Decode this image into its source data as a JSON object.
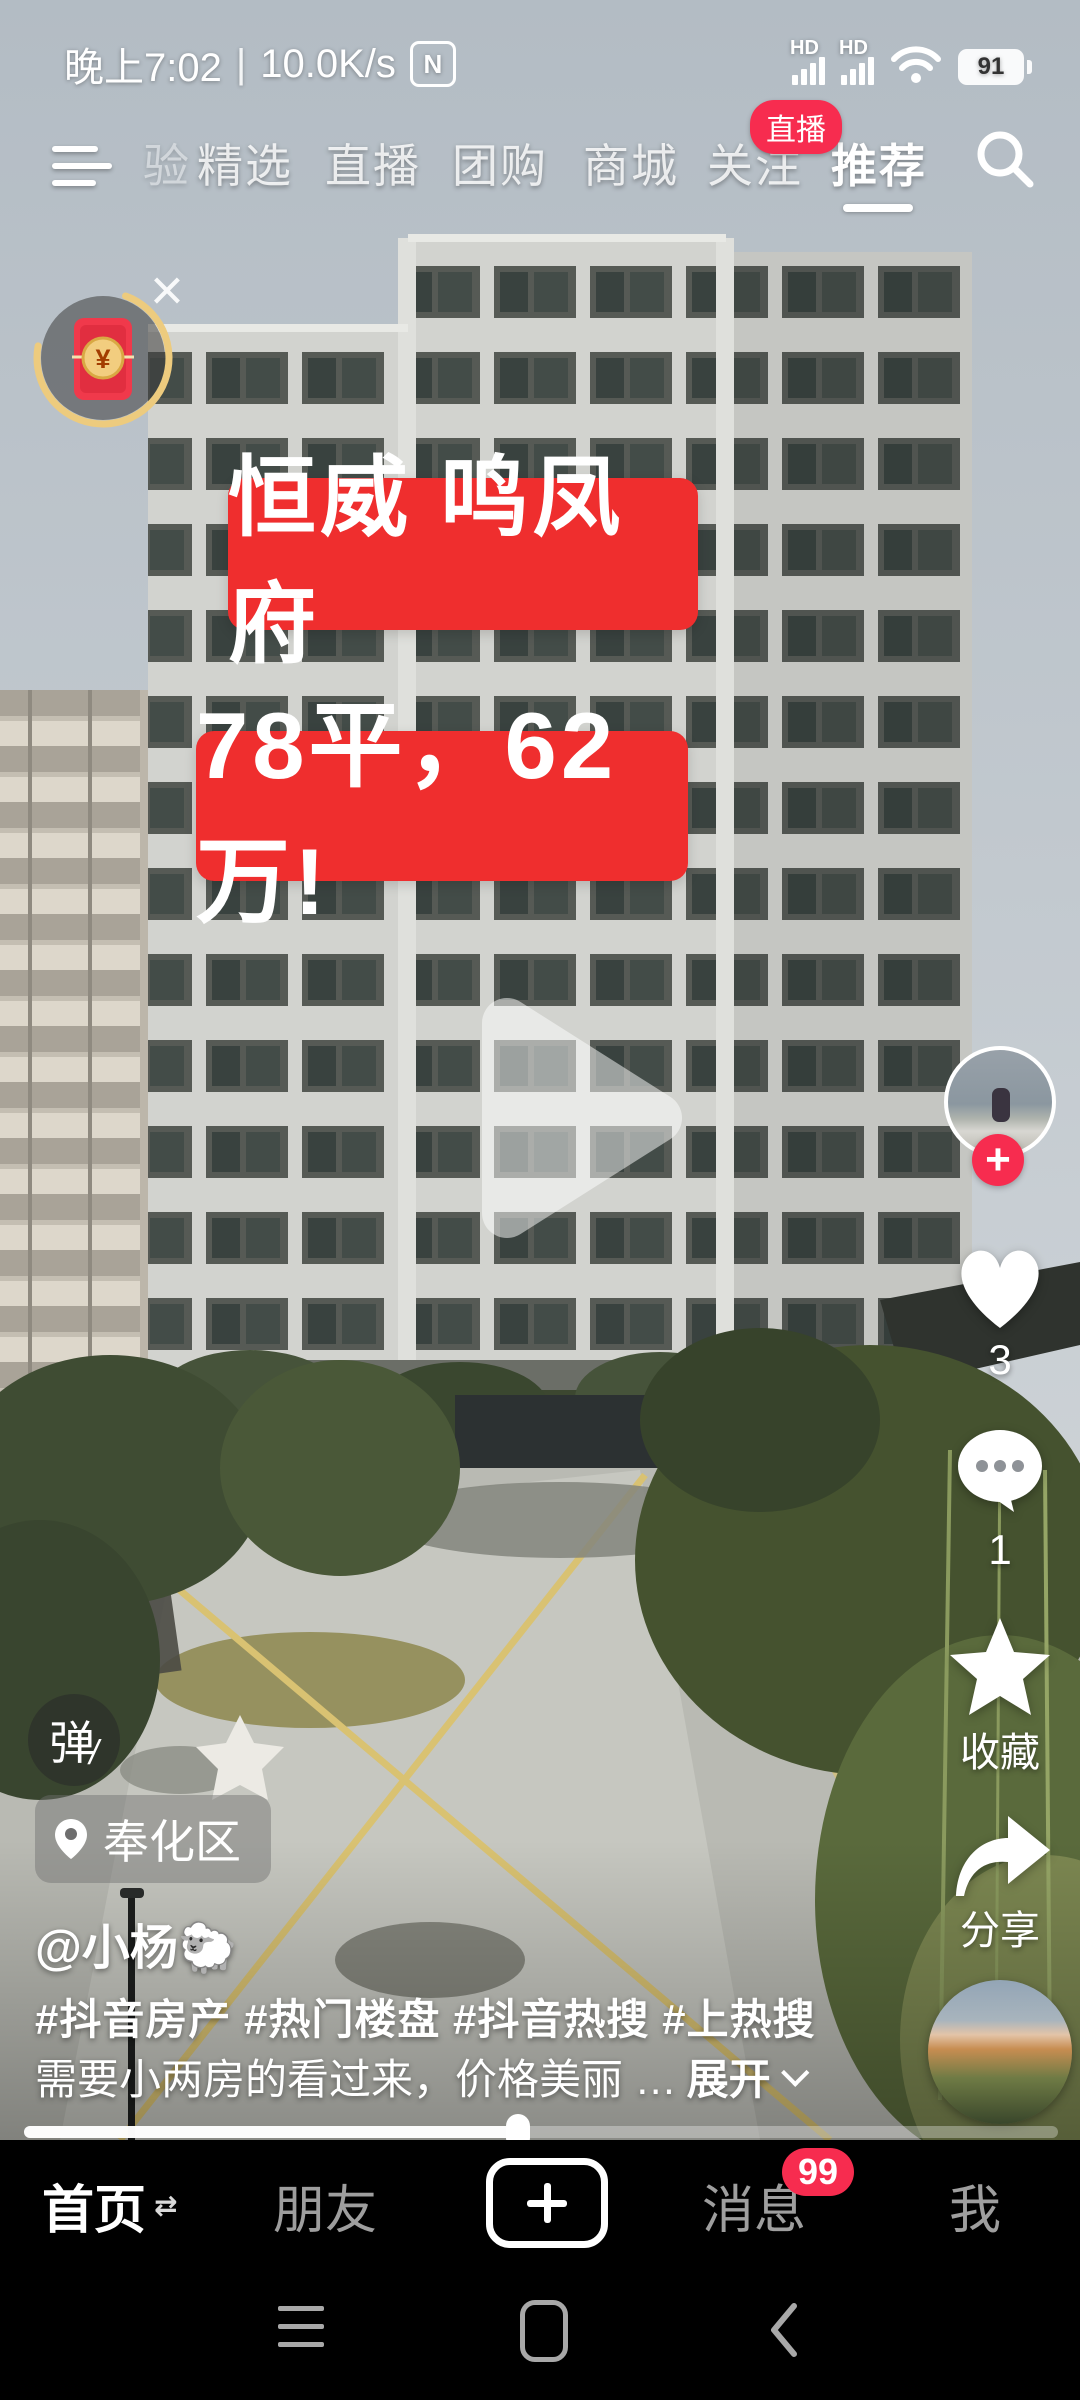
{
  "status_bar": {
    "time": "晚上7:02",
    "divider": "|",
    "net_speed": "10.0K/s",
    "nfc": "N",
    "hd": "HD",
    "battery_percent": "91"
  },
  "top_nav": {
    "partial_tab": "验",
    "tabs": [
      "精选",
      "直播",
      "团购",
      "商城",
      "关注",
      "推荐"
    ],
    "active_tab": "推荐",
    "live_badge": "直播"
  },
  "overlay": {
    "close": "×",
    "banner_line1": "恒威 鸣凤府",
    "banner_line2": "78平，62万!",
    "banner_color": "#ef2e2e",
    "coin_symbol": "¥"
  },
  "right_rail": {
    "like_count": "3",
    "comment_count": "1",
    "favorite_label": "收藏",
    "share_label": "分享",
    "follow_plus": "+"
  },
  "meta": {
    "danmu_label": "弹",
    "danmu_slash": "/",
    "location": "奉化区",
    "username": "@小杨🐑",
    "hashtags": "#抖音房产 #热门楼盘 #抖音热搜 #上热搜",
    "description": "需要小两房的看过来，价格美丽 …",
    "expand_label": "展开"
  },
  "bottom_nav": {
    "home": "首页",
    "home_switch_icon": "⇄",
    "friends": "朋友",
    "messages": "消息",
    "messages_badge": "99",
    "me": "我"
  },
  "colors": {
    "accent_red": "#f72c4f",
    "banner_red": "#ef2e2e",
    "nav_bg": "#000000"
  }
}
